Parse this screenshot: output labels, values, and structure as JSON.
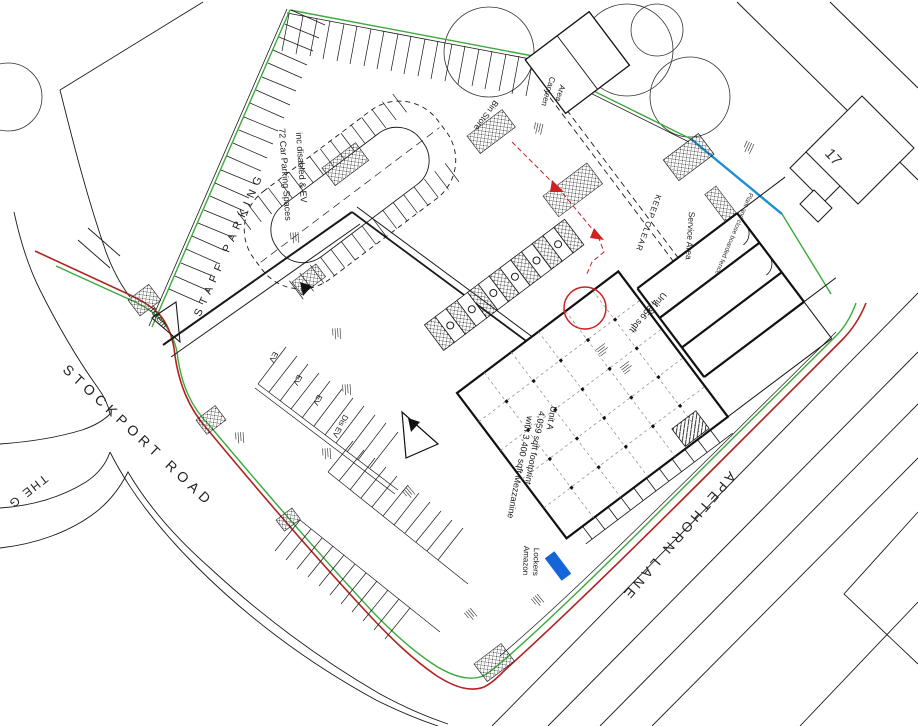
{
  "drawing_type": "Proposed site plan",
  "roads": {
    "stockport_road": "STOCKPORT ROAD",
    "apethorn_lane": "APETHORN LANE",
    "the_grove_partial": "THE G"
  },
  "parking": {
    "staff_parking": "STAFF PARKING",
    "note_line1": "72 Car Parking Spaces",
    "note_line2": "inc disabled & EV",
    "ev_bay": "EV",
    "disabled_ev_bay": "Dis EV",
    "totem": "Totem"
  },
  "buildings": {
    "unit_a": {
      "name": "Unit A",
      "area_line": "4,059 sqft footprint",
      "mezzanine_line": "with 3,400 sqft Mezzanine"
    },
    "unit_d": {
      "name": "Unit D",
      "area": "4,356 sqft"
    },
    "service_area": "Service Area",
    "keep_clear": "KEEP CLEAR",
    "bin_store": "Bin Store",
    "canteen_line1": "Canteen",
    "canteen_line2": "Area",
    "amazon_line1": "Amazon",
    "amazon_line2": "Lockers",
    "neighbour_house_number": "17"
  },
  "annotations": {
    "fence_note": "Plant and close boarded fence"
  },
  "colors": {
    "boundary_red": "#b22222",
    "boundary_green": "#3aaa3a",
    "fence_blue": "#1a8fd1",
    "marker_blue": "#1565d8",
    "annotation_red": "#cc2222",
    "line_black": "#1a1a1a"
  }
}
